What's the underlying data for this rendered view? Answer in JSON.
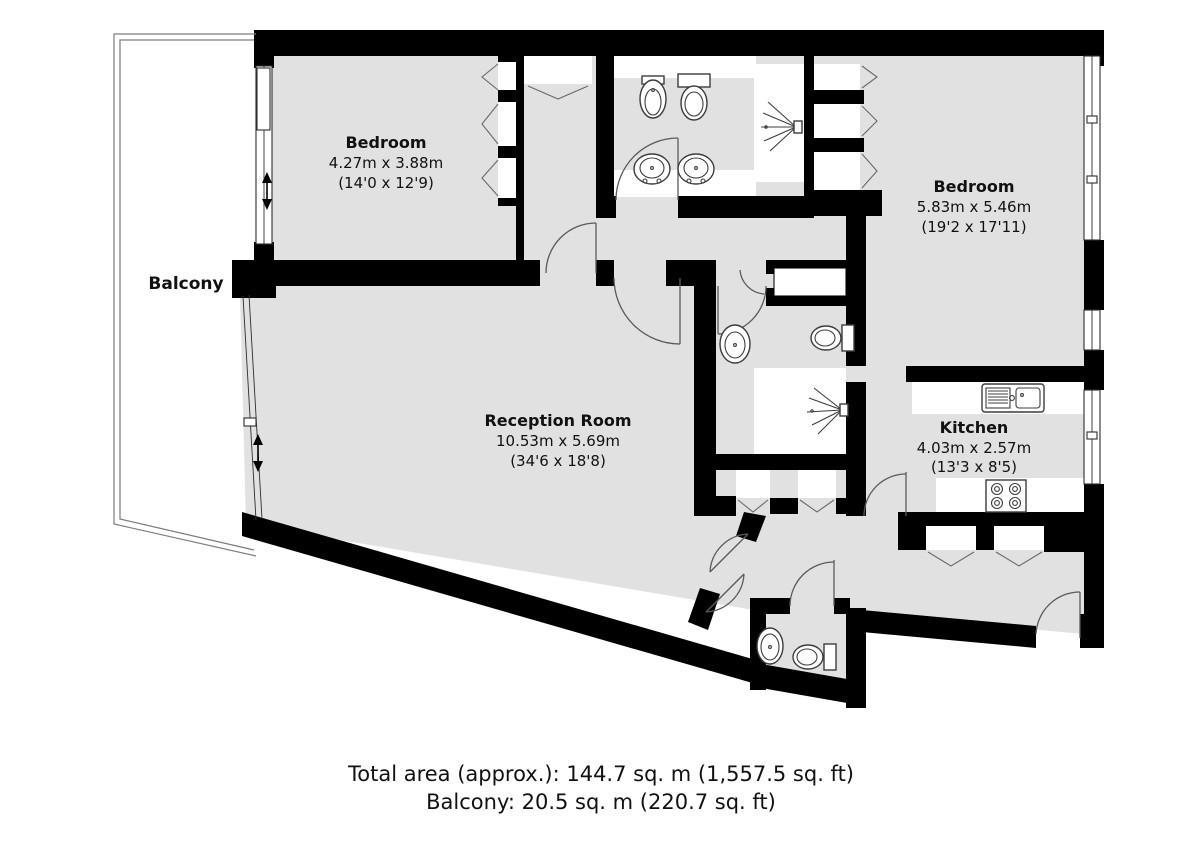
{
  "floorplan": {
    "balcony_label": "Balcony",
    "rooms": [
      {
        "name": "Bedroom",
        "metric": "4.27m x 3.88m",
        "imperial": "(14'0 x 12'9)"
      },
      {
        "name": "Bedroom",
        "metric": "5.83m x 5.46m",
        "imperial": "(19'2 x 17'11)"
      },
      {
        "name": "Reception Room",
        "metric": "10.53m x 5.69m",
        "imperial": "(34'6 x 18'8)"
      },
      {
        "name": "Kitchen",
        "metric": "4.03m x 2.57m",
        "imperial": "(13'3 x 8'5)"
      }
    ],
    "footer": {
      "total_area": "Total area (approx.): 144.7 sq. m (1,557.5 sq. ft)",
      "balcony_area": "Balcony: 20.5 sq. m (220.7 sq. ft)"
    },
    "colors": {
      "wall": "#000000",
      "floor": "#e1e1e1",
      "outline": "#555555"
    },
    "fixture_icons": [
      "toilet-icon",
      "bidet-icon",
      "basin-icon",
      "shower-icon",
      "kitchen-sink-icon",
      "hob-icon",
      "wardrobe-icon",
      "window-icon",
      "door-icon"
    ]
  }
}
